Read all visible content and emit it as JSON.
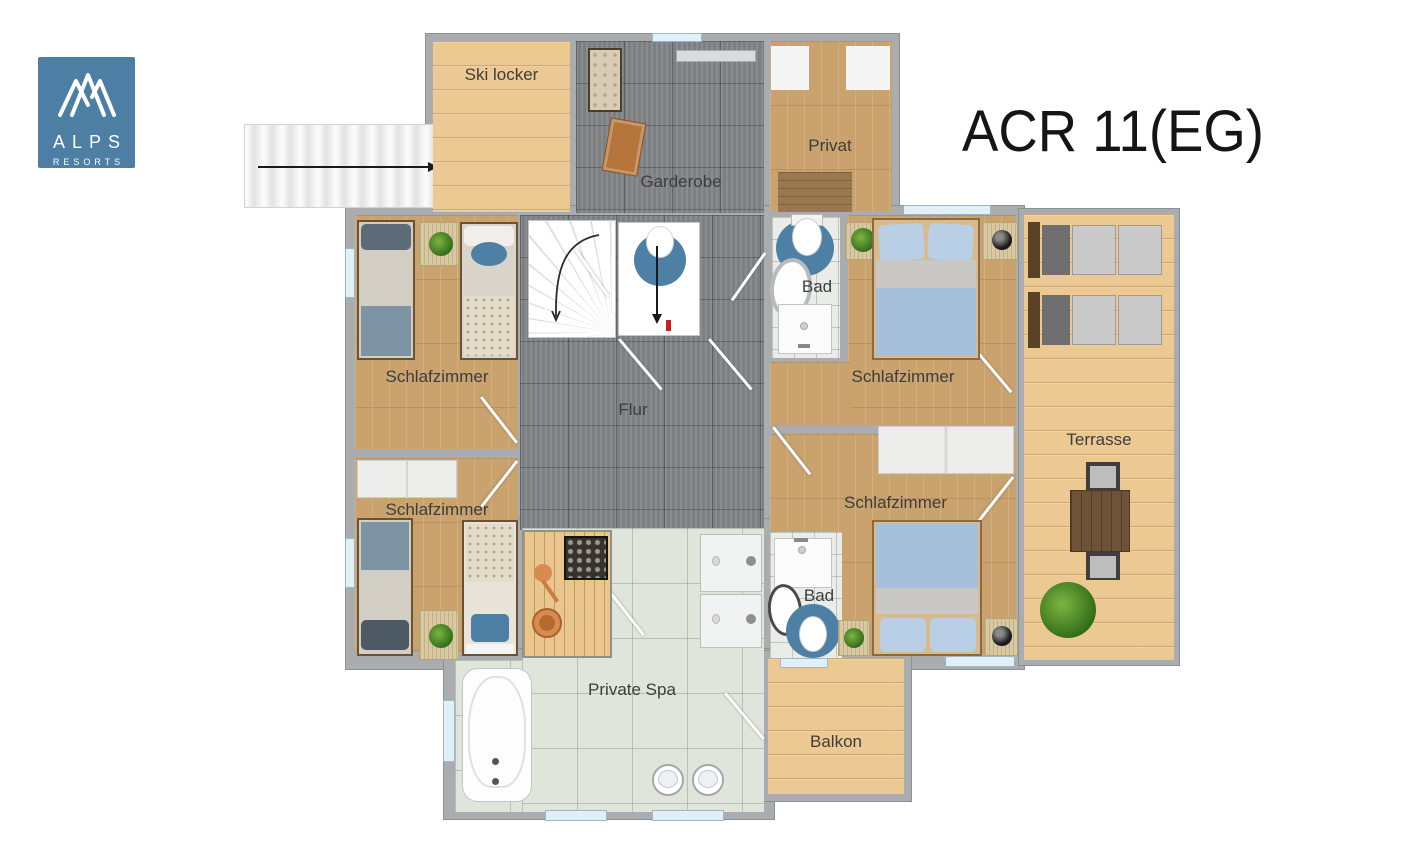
{
  "logo": {
    "name": "Alps Resorts",
    "line1": "ALPS",
    "line2": "RESORTS"
  },
  "title": "ACR 11(EG)",
  "rooms": {
    "ski_locker": {
      "label": "Ski locker"
    },
    "garderobe": {
      "label": "Garderobe"
    },
    "privat": {
      "label": "Privat"
    },
    "bad_top": {
      "label": "Bad"
    },
    "schlafzimmer_top_left": {
      "label": "Schlafzimmer"
    },
    "schlafzimmer_top_right": {
      "label": "Schlafzimmer"
    },
    "flur": {
      "label": "Flur"
    },
    "terrasse": {
      "label": "Terrasse"
    },
    "schlafzimmer_bottom_left": {
      "label": "Schlafzimmer"
    },
    "schlafzimmer_bottom_right": {
      "label": "Schlafzimmer"
    },
    "bad_bottom": {
      "label": "Bad"
    },
    "private_spa": {
      "label": "Private Spa"
    },
    "balkon": {
      "label": "Balkon"
    }
  },
  "colors": {
    "brand_blue": "#4d7ea3",
    "accent_blue": "#4e7fa5",
    "wall_gray": "#a9adb0",
    "window_blue": "#dff0f8",
    "arrow_red": "#c32222"
  }
}
